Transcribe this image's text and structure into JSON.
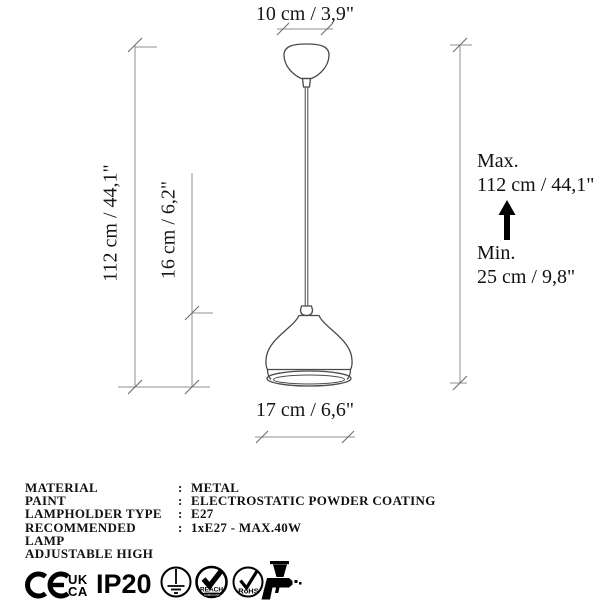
{
  "diagram": {
    "canopy_width": "10 cm / 3,9\"",
    "height_total": "112 cm / 44,1\"",
    "shade_height": "16 cm / 6,2\"",
    "shade_width": "17 cm / 6,6\"",
    "max_label": "Max.",
    "max_value": "112 cm / 44,1\"",
    "min_label": "Min.",
    "min_value": "25 cm / 9,8\""
  },
  "specs": {
    "rows": [
      {
        "label": "MATERIAL",
        "sep": ":",
        "value": "METAL"
      },
      {
        "label": "PAINT",
        "sep": ":",
        "value": "ELECTROSTATIC POWDER COATING"
      },
      {
        "label": "LAMPHOLDER TYPE",
        "sep": ":",
        "value": "E27"
      },
      {
        "label": "RECOMMENDED LAMP",
        "sep": ":",
        "value": "1xE27 - MAX.40W"
      },
      {
        "label": "ADJUSTABLE HIGH",
        "sep": "",
        "value": ""
      }
    ]
  },
  "certifications": {
    "ce_mark": "CE",
    "ukca_line1": "UK",
    "ukca_line2": "CA",
    "ip_rating": "IP20",
    "reach_label": "REACH",
    "reach_sub": "COMPLIANT",
    "rohs_label": "RoHS"
  },
  "colors": {
    "background": "#ffffff",
    "drawing_line": "#4a4a4a",
    "dimension_line": "#8f8f8f",
    "text": "#111111",
    "mark": "#000000"
  }
}
